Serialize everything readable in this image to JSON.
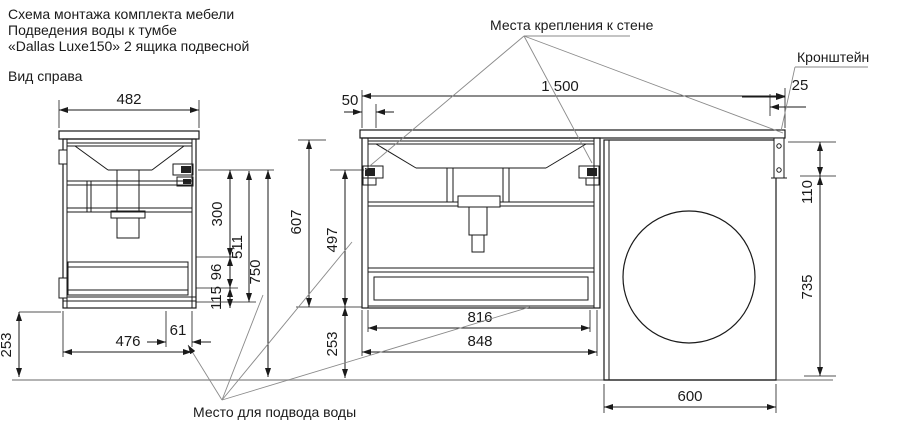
{
  "title": {
    "line1": "Схема монтажа комплекта мебели",
    "line2": "Подведения воды к тумбе",
    "line3": "«Dallas Luxe150» 2 ящика подвесной",
    "view": "Вид справа"
  },
  "labels": {
    "wall_mount": "Места крепления к стене",
    "bracket": "Кронштейн",
    "water": "Место для подвода воды"
  },
  "dims": {
    "w482": "482",
    "d300": "300",
    "d511": "511",
    "d750": "750",
    "d96": "96",
    "d115": "115",
    "d61": "61",
    "d476": "476",
    "d253_side": "253",
    "d50": "50",
    "d1500": "1 500",
    "d25": "25",
    "d607": "607",
    "d497": "497",
    "d253_front": "253",
    "d110": "110",
    "d735": "735",
    "d816": "816",
    "d848": "848",
    "d600": "600"
  },
  "colors": {
    "line": "#1a1a1a",
    "floor": "#9a9a9a",
    "leader": "#8a8a8a"
  }
}
